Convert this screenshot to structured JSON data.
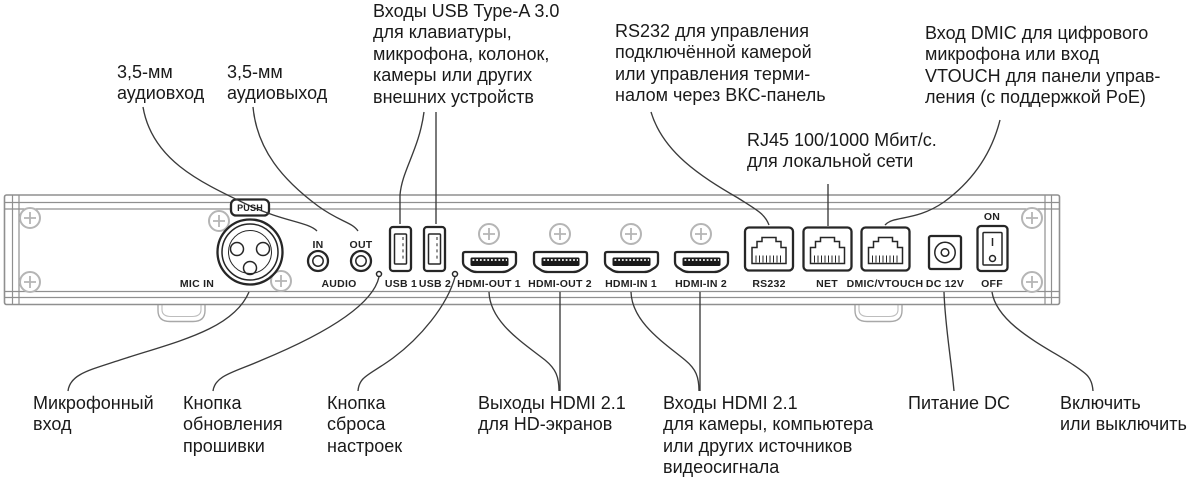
{
  "colors": {
    "ink": "#1a1a1a",
    "leader": "#3a3a3a",
    "port": "#262626",
    "chassis": "#8f8f8f",
    "chassis-light": "#a8a8a8",
    "screw": "#b5b5b5"
  },
  "callouts": {
    "audio_in": [
      "3,5-мм",
      "аудиовход"
    ],
    "audio_out": [
      "3,5-мм",
      "аудиовыход"
    ],
    "usb": [
      "Входы USB Type-A 3.0",
      "для клавиатуры,",
      "микрофона, колонок,",
      "камеры или других",
      "внешних устройств"
    ],
    "rs232": [
      "RS232 для управления",
      "подключённой камерой",
      "или управления терми-",
      "налом через ВКС-панель"
    ],
    "dmic": [
      "Вход DMIC для цифрового",
      "микрофона или вход",
      "VTOUCH для панели управ-",
      "ления (с поддержкой PoE)"
    ],
    "rj45": [
      "RJ45 100/1000 Мбит/с.",
      "для локальной сети"
    ],
    "mic": [
      "Микрофонный",
      "вход"
    ],
    "firmware": [
      "Кнопка",
      "обновления",
      "прошивки"
    ],
    "reset": [
      "Кнопка",
      "сброса",
      "настроек"
    ],
    "hdmi_out": [
      "Выходы HDMI 2.1",
      "для HD-экранов"
    ],
    "hdmi_in": [
      "Входы HDMI 2.1",
      "для камеры, компьютера",
      "или других источников",
      "видеосигнала"
    ],
    "power": [
      "Питание DC"
    ],
    "onoff": [
      "Включить",
      "или выключить"
    ]
  },
  "panel": {
    "push": "PUSH",
    "mic_in": "MIC IN",
    "in": "IN",
    "out": "OUT",
    "audio": "AUDIO",
    "usb1": "USB 1",
    "usb2": "USB 2",
    "hdmi_out1": "HDMI-OUT 1",
    "hdmi_out2": "HDMI-OUT 2",
    "hdmi_in1": "HDMI-IN 1",
    "hdmi_in2": "HDMI-IN 2",
    "rs232": "RS232",
    "net": "NET",
    "dmic_vtouch": "DMIC/VTOUCH",
    "dc": "DC 12V",
    "on": "ON",
    "off": "OFF"
  }
}
